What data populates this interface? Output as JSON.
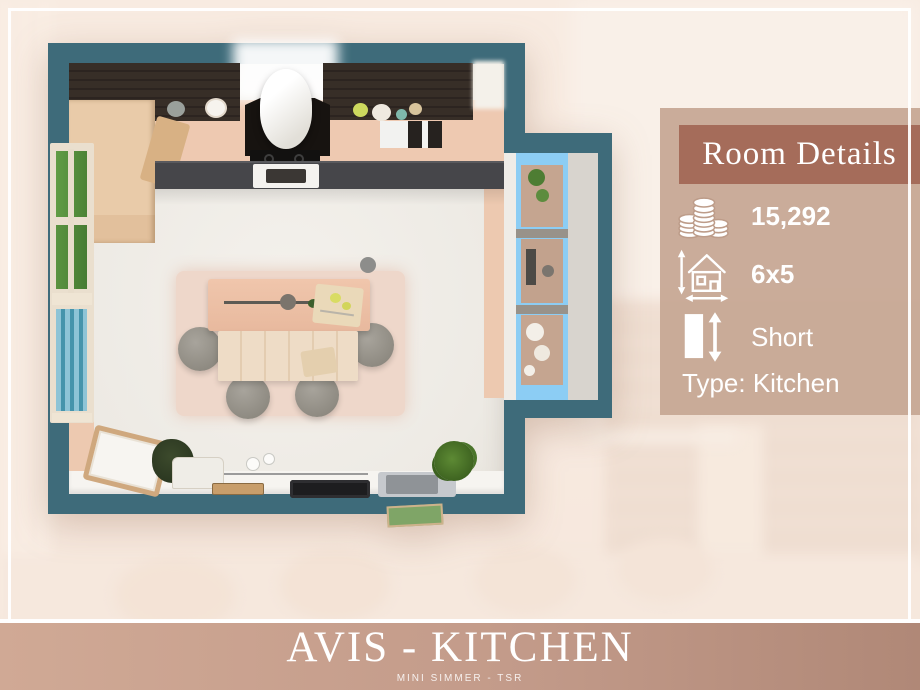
{
  "panel": {
    "title": "Room Details",
    "price": {
      "icon": "coins-icon",
      "value": "15,292"
    },
    "size": {
      "icon": "house-dimensions-icon",
      "value": "6x5"
    },
    "wall_height": {
      "icon": "wall-height-icon",
      "value": "Short"
    },
    "type_label": "Type: Kitchen"
  },
  "footer": {
    "title": "AVIS - KITCHEN",
    "subtitle": "MINI SIMMER - TSR"
  },
  "colors": {
    "wall_teal": "#3e6b7a",
    "panel_header": "#a56c5a",
    "panel_bg": "#c5a692",
    "footer_left": "#d0a995",
    "footer_right": "#b08877",
    "shelf_blue": "#8ccdf4",
    "counter_peach": "#eec9b1",
    "cabinet_dark": "#352c25"
  }
}
